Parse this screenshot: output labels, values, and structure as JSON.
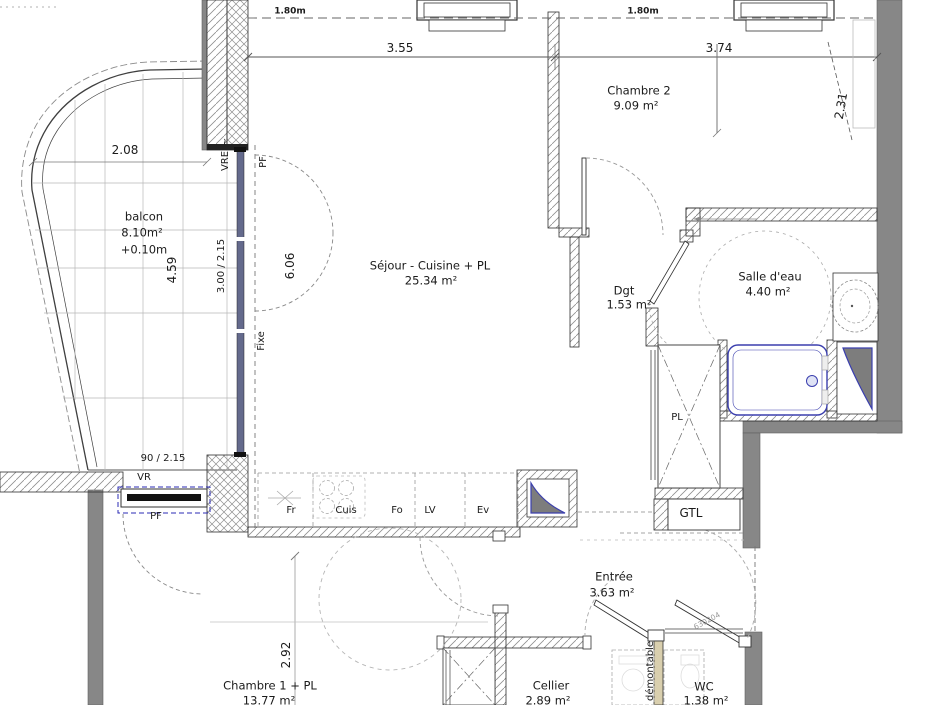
{
  "plan": {
    "rooms": {
      "balcon": {
        "name": "balcon",
        "area": "8.10m²",
        "level": "+0.10m"
      },
      "sejour": {
        "name": "Séjour - Cuisine + PL",
        "area": "25.34 m²"
      },
      "chambre2": {
        "name": "Chambre 2",
        "area": "9.09 m²"
      },
      "dgt": {
        "name": "Dgt",
        "area": "1.53 m²"
      },
      "salle_eau": {
        "name": "Salle d'eau",
        "area": "4.40 m²"
      },
      "entree": {
        "name": "Entrée",
        "area": "3.63 m²"
      },
      "cellier": {
        "name": "Cellier",
        "area": "2.89 m²"
      },
      "wc": {
        "name": "WC",
        "area": "1.38 m²"
      },
      "chambre1": {
        "name": "Chambre 1 + PL",
        "area": "13.77 m²"
      }
    },
    "storage": {
      "pl": "PL",
      "gtl": "GTL"
    },
    "kitchen_fixtures": {
      "fridge": "Fr",
      "cooktop": "Cuis",
      "oven": "Fo",
      "dishwasher": "LV",
      "sink": "Ev"
    },
    "dimensions": {
      "ceiling_line_left": "1.80m",
      "ceiling_line_right": "1.80m",
      "sejour_width": "3.55",
      "chambre2_width": "3.74",
      "chambre2_depth": "2.31",
      "balcon_width": "2.08",
      "balcon_depth": "4.59",
      "bay_window_size": "3.00 / 2.15",
      "sejour_length": "6.06",
      "chambre1_window_size": "90 / 2.15",
      "chambre1_width": "2.92"
    },
    "window_tags": {
      "vre": "VRE",
      "vre_note": "~",
      "pf_bay": "PF",
      "fixe": "Fixe",
      "vr": "VR",
      "pf_chambre1": "PF"
    },
    "notes": {
      "partition": "démontable",
      "door_ref": "630204"
    },
    "colors": {
      "wall_gray": "#878787",
      "window_blue": "#646a8c",
      "fixture_blue": "#3b3fae",
      "partition_beige": "#d9cfae"
    }
  }
}
